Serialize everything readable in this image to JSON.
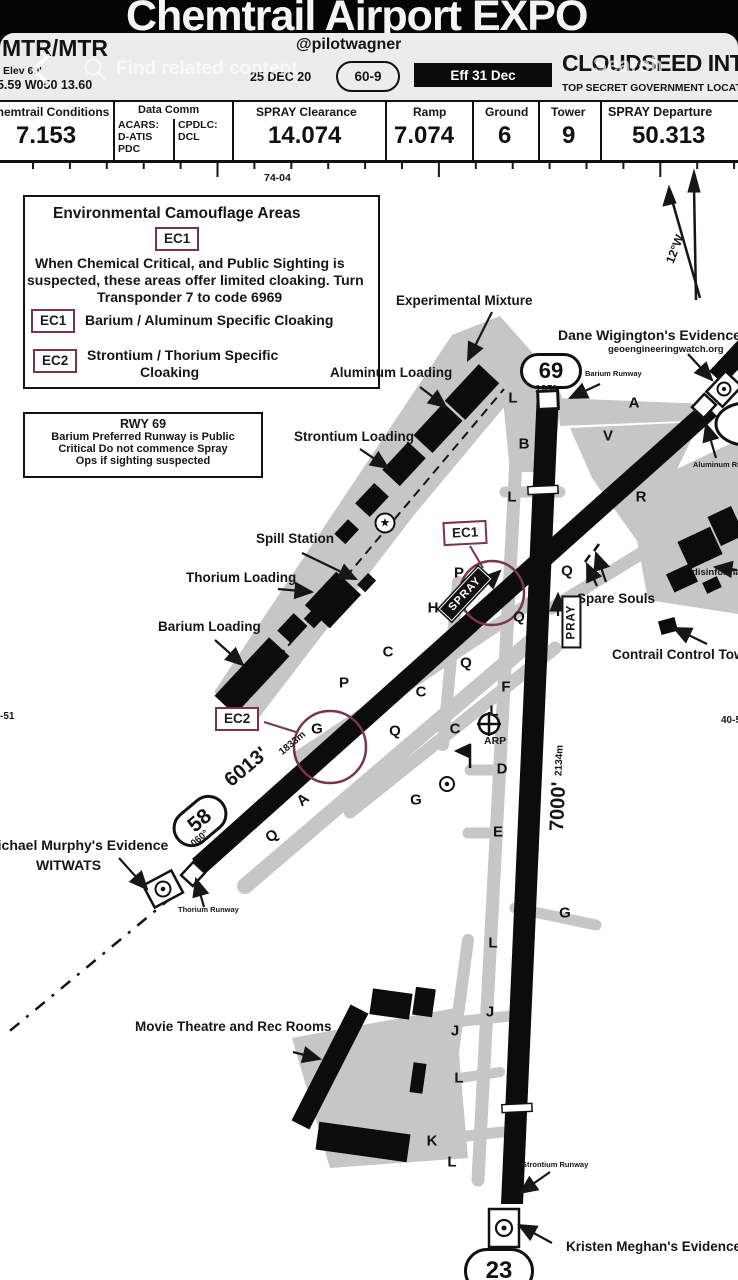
{
  "overlay": {
    "search_placeholder": "Find related content",
    "search_label": "Search"
  },
  "titlebar": {
    "title": "Chemtrail Airport EXPO"
  },
  "header": {
    "handle": "@pilotwagner",
    "ident": "MTR/MTR",
    "elev": "Elev 69'",
    "coords": "45.59 W050 13.60",
    "date": "25 DEC 20",
    "chart_index": "60-9",
    "effective": "Eff 31 Dec",
    "airport_name": "CLOUDSEED INTL",
    "airport_subtitle": "TOP SECRET GOVERNMENT LOCATION"
  },
  "datastrip": {
    "atis_label": "Chemtrail Conditions",
    "atis_value": "7.153",
    "datacomm_label": "Data Comm",
    "acars": "ACARS:\nD-ATIS\nPDC",
    "cpdlc": "CPDLC:\nDCL",
    "clearance_label": "SPRAY Clearance",
    "clearance_value": "14.074",
    "ramp_label": "Ramp",
    "ramp_value": "7.074",
    "ground_label": "Ground",
    "ground_value": "6",
    "tower_label": "Tower",
    "tower_value": "9",
    "departure_label": "SPRAY Departure",
    "departure_value": "50.313"
  },
  "map": {
    "coord_top": "74-04",
    "coord_left": "-51",
    "coord_right": "40-5",
    "variation": "12°W",
    "ec_box": {
      "title": "Environmental Camouflage Areas",
      "badge": "EC1",
      "body_l1": "When Chemical Critical, and Public Sighting is",
      "body_l2": "suspected, these areas offer limited cloaking. Turn",
      "body_l3": "Transponder 7 to code 6969",
      "ec1_badge": "EC1",
      "ec1_text": "Barium / Aluminum Specific Cloaking",
      "ec2_badge": "EC2",
      "ec2_text_l1": "Strontium / Thorium Specific",
      "ec2_text_l2": "Cloaking"
    },
    "rwy_box": {
      "l1": "RWY 69",
      "l2": "Barium Preferred Runway is Public",
      "l3": "Critical Do not commence Spray",
      "l4": "Ops if sighting suspected"
    },
    "labels": {
      "experimental": "Experimental Mixture",
      "aluminum_loading": "Aluminum Loading",
      "strontium_loading": "Strontium Loading",
      "spill_station": "Spill Station",
      "thorium_loading": "Thorium Loading",
      "barium_loading": "Barium Loading",
      "dane": "Dane Wigington's Evidence",
      "dane_sub": "geoengineeringwatch.org",
      "barium_runway": "Barium Runway",
      "spare_souls": "Spare Souls",
      "disinform": "disinformation",
      "contrail_tower": "Contrail Control Tower",
      "aluminum_runway": "Aluminum Runway",
      "michael": "Michael Murphy's Evidence",
      "witwats": "WITWATS",
      "thorium_runway": "Thorium Runway",
      "movie": "Movie Theatre and Rec Rooms",
      "strontium_runway": "Strontium Runway",
      "kristen": "Kristen Meghan's Evidence",
      "arp": "ARP"
    },
    "runways": {
      "rwy69": "69",
      "rwy69_hdg": "195°",
      "rwy58": "58",
      "rwy58_hdg": "060°",
      "rwy23": "23",
      "len_diag": "6013'",
      "len_diag_m": "1833m",
      "len_vert": "7000'",
      "len_vert_m": "2134m"
    },
    "signs": {
      "spray": "SPRAY",
      "pray": "PRAY",
      "ec1": "EC1",
      "ec2": "EC2"
    },
    "taxiways": [
      {
        "t": "L",
        "x": 513,
        "y": 398
      },
      {
        "t": "B",
        "x": 524,
        "y": 444
      },
      {
        "t": "A",
        "x": 634,
        "y": 403
      },
      {
        "t": "V",
        "x": 608,
        "y": 436
      },
      {
        "t": "R",
        "x": 641,
        "y": 497
      },
      {
        "t": "L",
        "x": 512,
        "y": 497
      },
      {
        "t": "Q",
        "x": 567,
        "y": 571
      },
      {
        "t": "P",
        "x": 459,
        "y": 573
      },
      {
        "t": "H",
        "x": 433,
        "y": 608
      },
      {
        "t": "Q",
        "x": 519,
        "y": 617
      },
      {
        "t": "Q",
        "x": 466,
        "y": 663
      },
      {
        "t": "C",
        "x": 388,
        "y": 652
      },
      {
        "t": "C",
        "x": 421,
        "y": 692
      },
      {
        "t": "P",
        "x": 344,
        "y": 683
      },
      {
        "t": "G",
        "x": 317,
        "y": 729
      },
      {
        "t": "Q",
        "x": 395,
        "y": 731
      },
      {
        "t": "C",
        "x": 455,
        "y": 729
      },
      {
        "t": "F",
        "x": 506,
        "y": 687
      },
      {
        "t": "L",
        "x": 494,
        "y": 711
      },
      {
        "t": "D",
        "x": 502,
        "y": 769
      },
      {
        "t": "G",
        "x": 416,
        "y": 800
      },
      {
        "t": "E",
        "x": 498,
        "y": 832
      },
      {
        "t": "Q",
        "x": 272,
        "y": 836,
        "r": -40
      },
      {
        "t": "A",
        "x": 303,
        "y": 800,
        "r": -40
      },
      {
        "t": "G",
        "x": 565,
        "y": 913
      },
      {
        "t": "L",
        "x": 493,
        "y": 943
      },
      {
        "t": "J",
        "x": 490,
        "y": 1012
      },
      {
        "t": "J",
        "x": 455,
        "y": 1031
      },
      {
        "t": "L",
        "x": 459,
        "y": 1078
      },
      {
        "t": "K",
        "x": 432,
        "y": 1141
      },
      {
        "t": "L",
        "x": 452,
        "y": 1162
      }
    ]
  }
}
